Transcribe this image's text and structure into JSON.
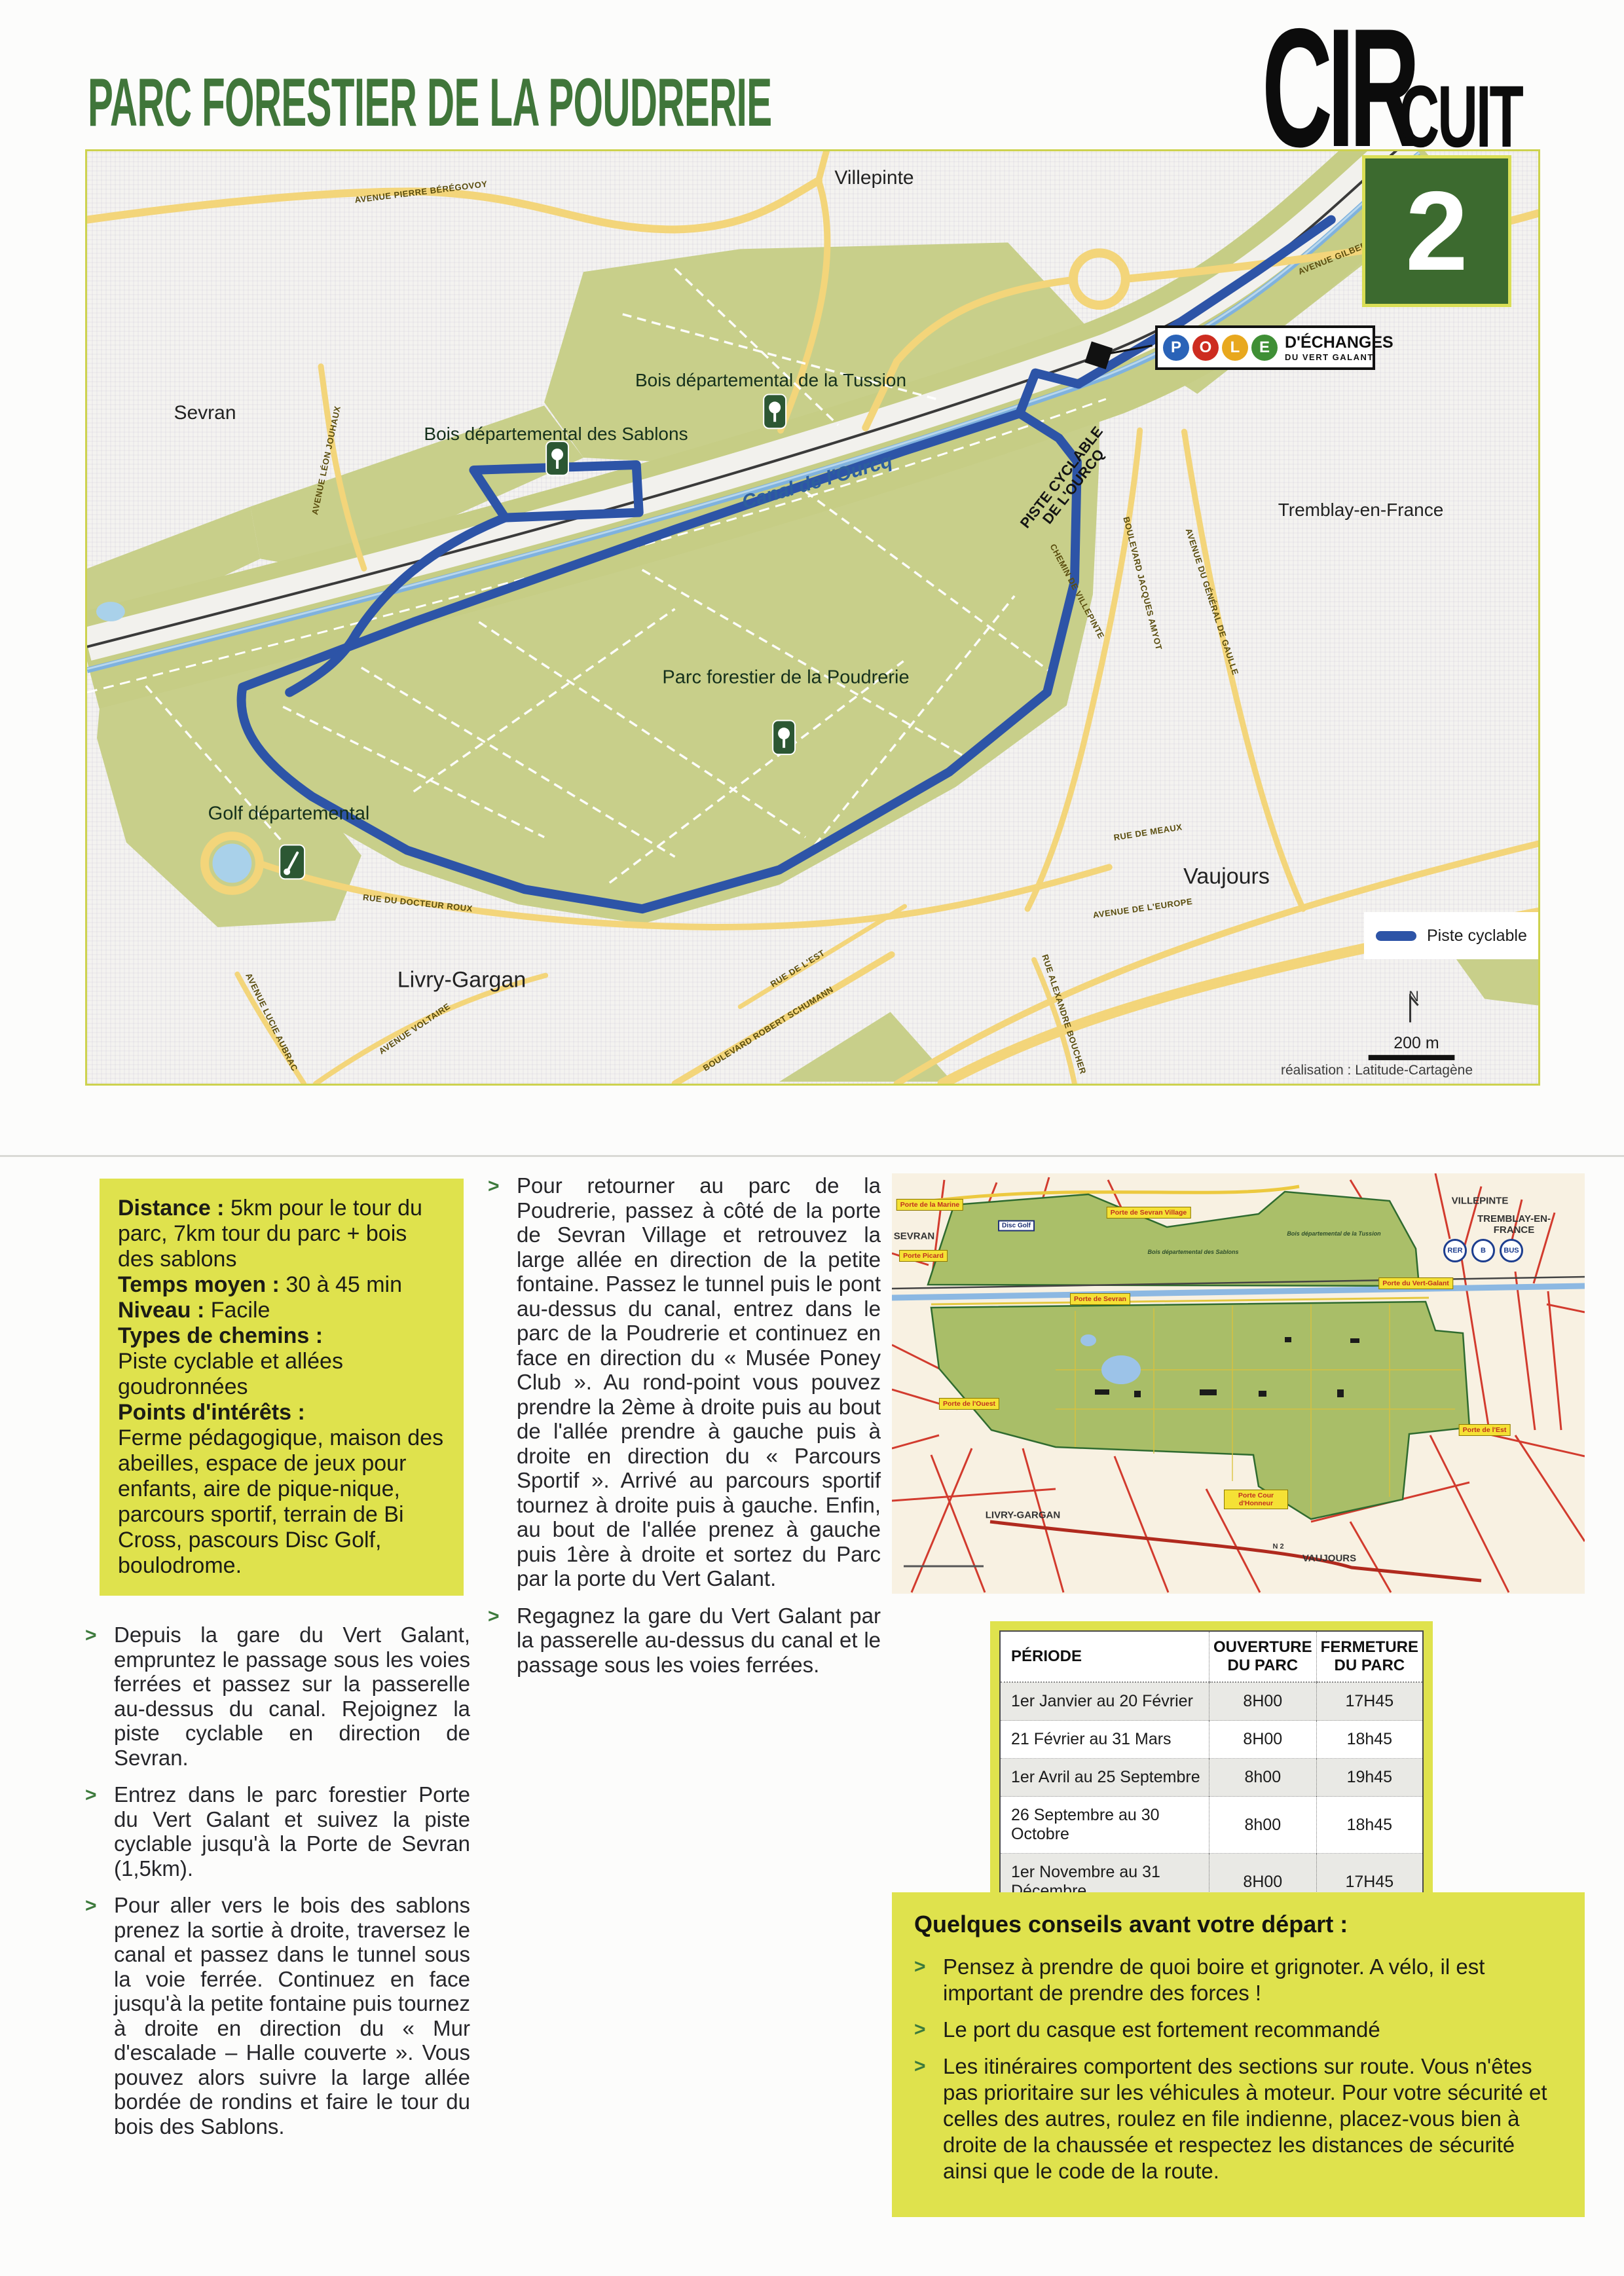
{
  "page": {
    "title": "PARC FORESTIER DE LA POUDRERIE",
    "circuit_word_part1": "CIR",
    "circuit_word_part2": "CUIT",
    "circuit_number": "2"
  },
  "colors": {
    "title_green": "#40763a",
    "accent_yellow": "#dfe24d",
    "route_blue": "#2d54a7",
    "circuit_box_green": "#3c6a2f",
    "park_green": "#c8cf8a",
    "canal_blue": "#7fb2de"
  },
  "map": {
    "cities": [
      "Villepinte",
      "Sevran",
      "Tremblay-en-France",
      "Vaujours",
      "Livry-Gargan"
    ],
    "areas": [
      "Bois départemental de la Tussion",
      "Bois départemental des Sablons",
      "Parc forestier de la Poudrerie",
      "Golf départemental"
    ],
    "canal_label": "Canal de l'Ourcq",
    "piste_line1": "PISTE CYCLABLE",
    "piste_line2": "DE L'OURCQ",
    "roads": [
      "AVENUE PIERRE BÉRÉGOVOY",
      "AVENUE GILBERT BERGER",
      "AVENUE LÉON JOUHAUX",
      "CHEMIN DE VILLEPINTE",
      "BOULEVARD JACQUES AMYOT",
      "AVENUE DU GÉNÉRAL DE GAULLE",
      "RUE DU DOCTEUR ROUX",
      "RUE DE MEAUX",
      "AVENUE DE L'EUROPE",
      "RUE ALEXANDRE BOUCHER",
      "AVENUE LUCIE AUBRAC",
      "AVENUE VOLTAIRE",
      "BOULEVARD ROBERT SCHUMANN",
      "RUE DE L'EST"
    ],
    "pole": {
      "letters": [
        "P",
        "O",
        "L",
        "E"
      ],
      "line1": "D'ÉCHANGES",
      "line2": "DU VERT GALANT"
    },
    "legend_label": "Piste cyclable",
    "north_label": "N",
    "scale_label": "200 m",
    "credit": "réalisation : Latitude-Cartagène"
  },
  "infobox": {
    "distance_label": "Distance :",
    "distance_text": "5km pour le tour du parc, 7km tour du parc + bois des sablons",
    "temps_label": "Temps moyen :",
    "temps_text": "30 à 45 min",
    "niveau_label": "Niveau :",
    "niveau_text": "Facile",
    "chemins_label": "Types de chemins :",
    "chemins_text": "Piste cyclable et allées goudronnées",
    "interets_label": "Points d'intérêts :",
    "interets_text": "Ferme pédagogique, maison des abeilles, espace de jeux pour enfants, aire de pique-nique, parcours sportif, terrain de Bi Cross, pascours Disc Golf, boulodrome."
  },
  "directions_left": [
    "Depuis la gare du Vert Galant, empruntez le passage sous les voies ferrées et passez sur la passerelle au-dessus du canal. Rejoignez la piste cyclable en direction de Sevran.",
    "Entrez dans le parc forestier Porte du Vert Galant et suivez la piste cyclable jusqu'à la Porte de Sevran (1,5km).",
    "Pour aller vers le bois des sablons prenez la sortie à droite, traversez le canal et passez dans le tunnel sous la voie ferrée. Continuez en face jusqu'à la petite fontaine puis tournez à droite en direction du « Mur d'escalade – Halle couverte ». Vous pouvez alors suivre la large allée bordée de rondins et faire le tour du bois des Sablons."
  ],
  "directions_mid": [
    "Pour retourner au parc de la Poudrerie, passez à côté de la porte de Sevran Village et retrouvez la large allée en direction de la petite fontaine. Passez le tunnel puis le pont au-dessus du canal, entrez dans le parc de la Poudrerie et continuez en face en direction du « Musée Poney Club ». Au rond-point vous pouvez prendre la 2ème à droite puis au bout de l'allée prendre à gauche puis à droite en direction du « Parcours Sportif ». Arrivé au parcours sportif tournez à droite puis à gauche. Enfin, au bout de l'allée prenez à gauche puis 1ère à droite et sortez du Parc par la porte du Vert Galant.",
    "Regagnez la gare du Vert Galant par la passerelle au-dessus du canal et le passage sous les voies ferrées."
  ],
  "minimap": {
    "cities": [
      "SEVRAN",
      "VILLEPINTE",
      "TREMBLAY-EN-FRANCE",
      "LIVRY-GARGAN",
      "VAUJOURS"
    ],
    "portes": [
      "Porte de la Marine",
      "Porte de Sevran Village",
      "Porte Picard",
      "Porte de Sevran",
      "Porte de l'Ouest",
      "Porte du Vert-Galant",
      "Porte de l'Est",
      "Porte Cour d'Honneur"
    ],
    "transit": [
      "RER",
      "B",
      "BUS"
    ],
    "bois": [
      "Bois départemental des Sablons",
      "Bois départemental de la Tussion"
    ],
    "disc_golf": "Disc Golf",
    "road_n2": "N 2"
  },
  "schedule": {
    "headers": [
      "PÉRIODE",
      "OUVERTURE DU PARC",
      "FERMETURE DU PARC"
    ],
    "rows": [
      [
        "1er Janvier au 20 Février",
        "8H00",
        "17H45"
      ],
      [
        "21 Février au 31 Mars",
        "8H00",
        "18h45"
      ],
      [
        "1er Avril au 25 Septembre",
        "8h00",
        "19h45"
      ],
      [
        "26 Septembre au 30 Octobre",
        "8h00",
        "18h45"
      ],
      [
        "1er Novembre au 31 Décembre",
        "8H00",
        "17H45"
      ]
    ]
  },
  "advice": {
    "title": "Quelques conseils avant votre départ :",
    "items": [
      "Pensez à prendre de quoi boire et grignoter. A vélo, il est important de prendre des forces !",
      "Le port du casque est fortement recommandé",
      "Les itinéraires comportent des sections sur route. Vous n'êtes pas prioritaire sur les véhicules à moteur. Pour votre sécurité et celles des autres, roulez en file indienne, placez-vous bien à droite de la chaussée et respectez les distances de sécurité ainsi que le code de la route."
    ]
  }
}
